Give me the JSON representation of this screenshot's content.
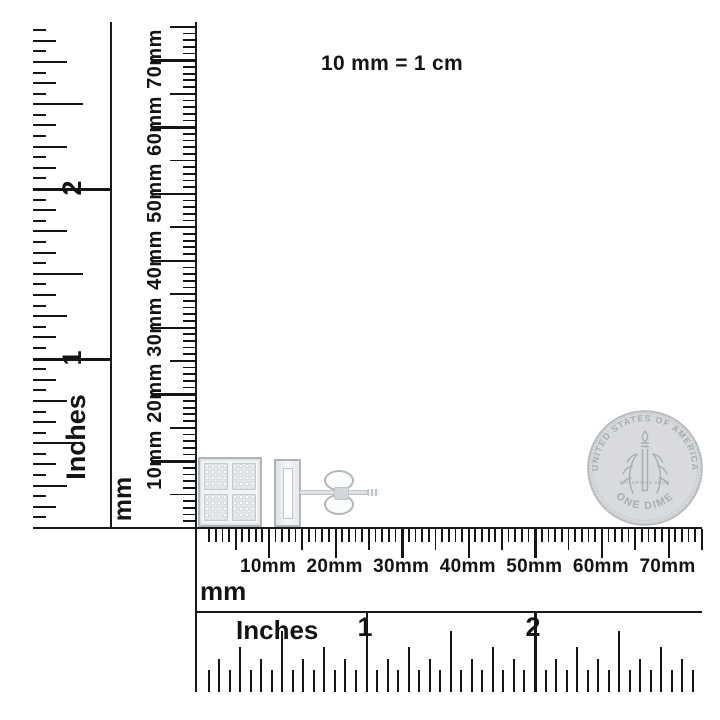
{
  "scale_note": "10 mm = 1 cm",
  "left_inches_ruler": {
    "unit_label": "Inches",
    "numerals": [
      "1",
      "2"
    ]
  },
  "vertical_mm_ruler": {
    "unit_label": "mm",
    "tick_labels": [
      "10mm",
      "20mm",
      "30mm",
      "40mm",
      "50mm",
      "60mm",
      "70mm"
    ]
  },
  "bottom_mm_ruler": {
    "unit_label": "mm",
    "tick_labels": [
      "10mm",
      "20mm",
      "30mm",
      "40mm",
      "50mm",
      "60mm",
      "70mm"
    ]
  },
  "bottom_inches_ruler": {
    "unit_label": "Inches",
    "numerals": [
      "1",
      "2"
    ]
  },
  "coin": {
    "legend_top": "UNITED STATES OF AMERICA",
    "denomination": "ONE DIME",
    "motto": "E PLURIBUS UNUM"
  },
  "colors": {
    "ink": "#141414",
    "background": "#ffffff",
    "coin_body": "#d8dadd",
    "coin_detail": "#a8adb3",
    "earring_metal": "#eef0f1",
    "earring_outline": "#b0b6bb"
  }
}
